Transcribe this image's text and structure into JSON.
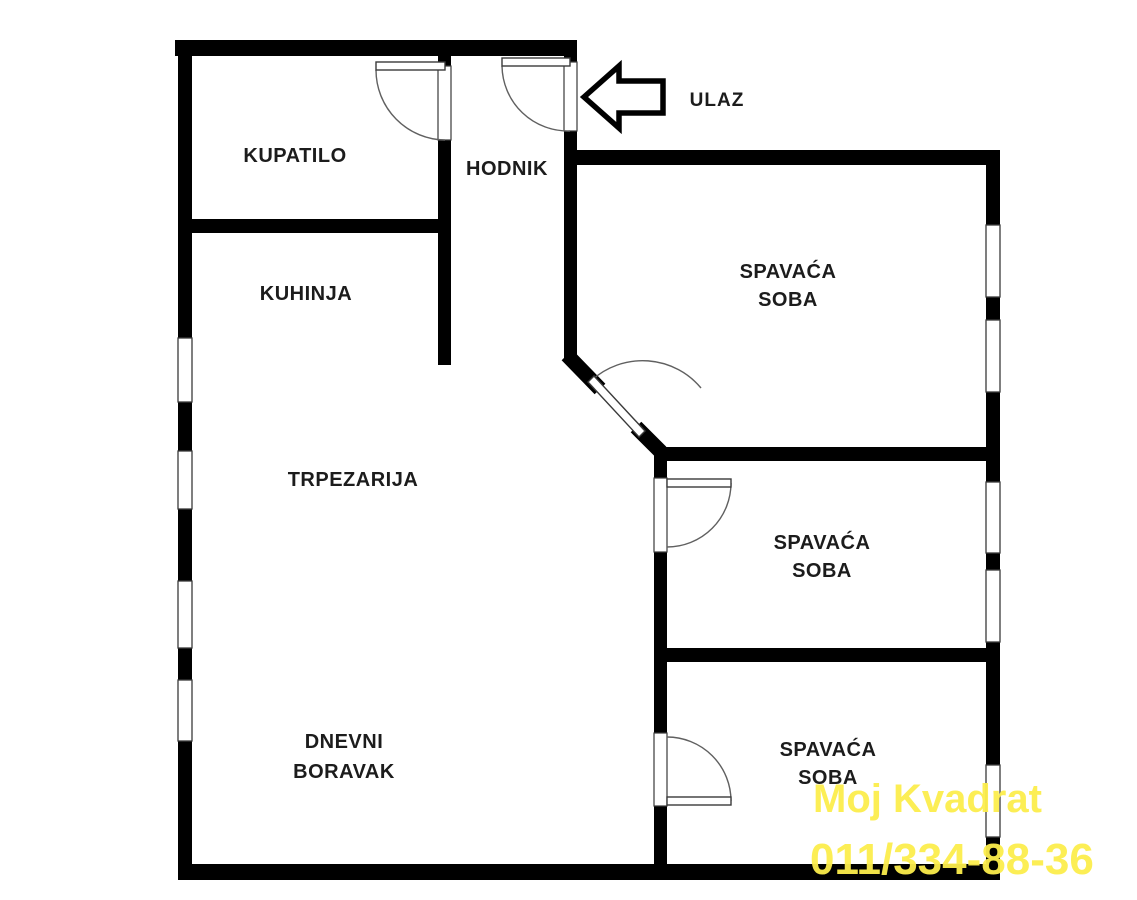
{
  "plan": {
    "colors": {
      "background": "#ffffff",
      "wall": "#000000",
      "frame": "#3a3a3a",
      "arc": "#606060",
      "label": "#1c1c1c",
      "watermark": "#fcee4c"
    },
    "rooms": {
      "kupatilo": {
        "label": "KUPATILO"
      },
      "hodnik": {
        "label": "HODNIK"
      },
      "kuhinja": {
        "label": "KUHINJA"
      },
      "trpezarija": {
        "label": "TRPEZARIJA"
      },
      "dnevni_boravak": {
        "line1": "DNEVNI",
        "line2": "BORAVAK"
      },
      "spavaca_soba_1": {
        "line1": "SPAVAĆA",
        "line2": "SOBA"
      },
      "spavaca_soba_2": {
        "line1": "SPAVAĆA",
        "line2": "SOBA"
      },
      "spavaca_soba_3": {
        "line1": "SPAVAĆA",
        "line2": "SOBA"
      }
    },
    "entrance": {
      "label": "ULAZ"
    },
    "watermark": {
      "line1": "Moj Kvadrat",
      "line2": "011/334-88-36"
    }
  }
}
